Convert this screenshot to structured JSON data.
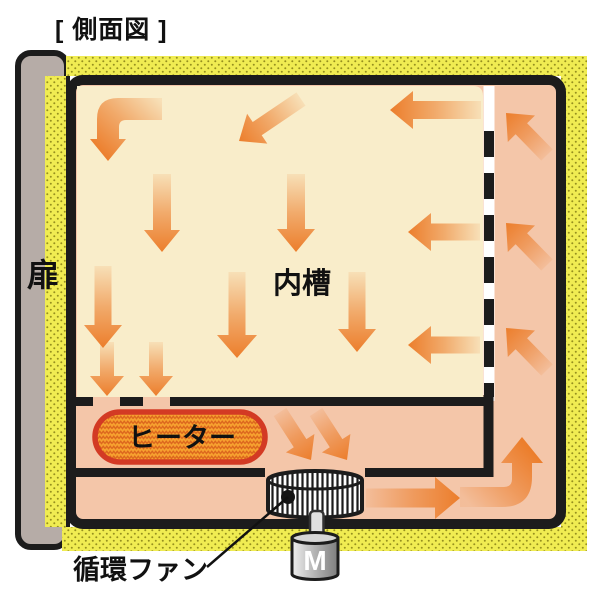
{
  "title": "[ 側面図 ]",
  "labels": {
    "door": "扉",
    "inner_chamber": "内槽",
    "heater": "ヒーター",
    "fan": "循環ファン",
    "motor": "M"
  },
  "colors": {
    "wall_black": "#1c1c1c",
    "chamber_cream": "#f9edca",
    "duct_salmon": "#f4c6a9",
    "insulation_yellow": "#f0ec52",
    "insulation_dot": "#96901e",
    "arrow_orange": "#ec7e2c",
    "heater_fill": "#f6a02f",
    "heater_zigzag": "#dc661d",
    "heater_border": "#d33a24",
    "door_gray": "#b6aca7"
  },
  "flow_arrows": {
    "straight": [
      {
        "id": "D1",
        "x1": 162,
        "y1": 174,
        "x2": 162,
        "y2": 252,
        "sw": 18,
        "hw": 36,
        "hl": 22
      },
      {
        "id": "D2",
        "x1": 296,
        "y1": 174,
        "x2": 296,
        "y2": 252,
        "sw": 18,
        "hw": 38,
        "hl": 23
      },
      {
        "id": "D3",
        "x1": 103,
        "y1": 266,
        "x2": 103,
        "y2": 348,
        "sw": 17,
        "hw": 38,
        "hl": 23
      },
      {
        "id": "D4",
        "x1": 237,
        "y1": 272,
        "x2": 237,
        "y2": 358,
        "sw": 17,
        "hw": 40,
        "hl": 23
      },
      {
        "id": "D5",
        "x1": 357,
        "y1": 272,
        "x2": 357,
        "y2": 352,
        "sw": 17,
        "hw": 38,
        "hl": 23
      },
      {
        "id": "S1",
        "x1": 107,
        "y1": 342,
        "x2": 107,
        "y2": 396,
        "sw": 14,
        "hw": 34,
        "hl": 20
      },
      {
        "id": "S2",
        "x1": 156,
        "y1": 342,
        "x2": 156,
        "y2": 396,
        "sw": 14,
        "hw": 34,
        "hl": 20
      },
      {
        "id": "L1",
        "x1": 481,
        "y1": 110,
        "x2": 390,
        "y2": 110,
        "sw": 18,
        "hw": 38,
        "hl": 23
      },
      {
        "id": "L2",
        "x1": 480,
        "y1": 232,
        "x2": 408,
        "y2": 232,
        "sw": 17,
        "hw": 38,
        "hl": 23
      },
      {
        "id": "L3",
        "x1": 480,
        "y1": 345,
        "x2": 408,
        "y2": 345,
        "sw": 17,
        "hw": 38,
        "hl": 23
      },
      {
        "id": "T1",
        "x1": 301,
        "y1": 99,
        "x2": 239,
        "y2": 141,
        "sw": 16,
        "hw": 36,
        "hl": 22
      },
      {
        "id": "R1",
        "x1": 547,
        "y1": 155,
        "x2": 506,
        "y2": 113,
        "sw": 16,
        "hw": 38,
        "hl": 22
      },
      {
        "id": "R2",
        "x1": 547,
        "y1": 265,
        "x2": 506,
        "y2": 223,
        "sw": 16,
        "hw": 38,
        "hl": 22
      },
      {
        "id": "R3",
        "x1": 547,
        "y1": 370,
        "x2": 506,
        "y2": 328,
        "sw": 16,
        "hw": 38,
        "hl": 22
      },
      {
        "id": "H1",
        "x1": 280,
        "y1": 412,
        "x2": 311,
        "y2": 460,
        "sw": 15,
        "hw": 34,
        "hl": 20
      },
      {
        "id": "H2",
        "x1": 316,
        "y1": 412,
        "x2": 347,
        "y2": 460,
        "sw": 15,
        "hw": 34,
        "hl": 20
      },
      {
        "id": "B1",
        "x1": 366,
        "y1": 498,
        "x2": 460,
        "y2": 498,
        "sw": 19,
        "hw": 42,
        "hl": 25
      }
    ],
    "elbows": [
      {
        "id": "E1",
        "path": "M162,98 L118,98 Q97,98 97,119 L97,139 L90,139 L108,161 L126,139 L119,139 L119,127 Q119,120 126,120 L162,120 Z",
        "x1": 160,
        "y1": 100,
        "x2": 105,
        "y2": 158
      },
      {
        "id": "E2",
        "path": "M460,487 L504,487 Q512,487 512,479 L512,463 L501,463 L522,437 L543,463 L532,463 L532,477 Q532,507 502,507 L460,507 Z",
        "x1": 463,
        "y1": 497,
        "x2": 522,
        "y2": 441
      }
    ]
  }
}
